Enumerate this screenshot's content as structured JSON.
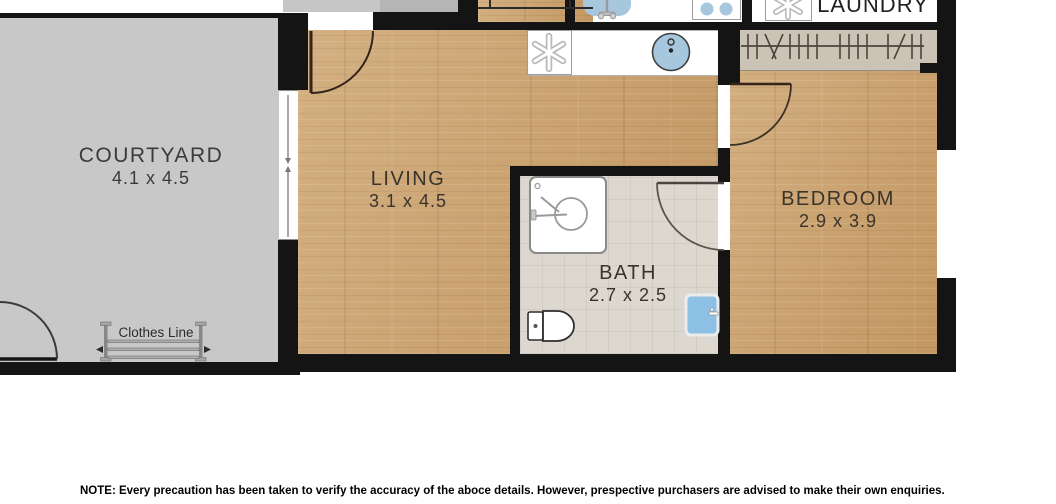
{
  "floorplan": {
    "rooms": [
      {
        "name": "COURTYARD",
        "dims": "4.1 x 4.5"
      },
      {
        "name": "LIVING",
        "dims": "3.1 x 4.5"
      },
      {
        "name": "BATH",
        "dims": "2.7 x 2.5"
      },
      {
        "name": "BEDROOM",
        "dims": "2.9 x 3.9"
      },
      {
        "name": "LAUNDRY"
      }
    ],
    "clothes_line_label": "Clothes Line",
    "icons": [
      "shower-icon",
      "toilet-icon",
      "vanity-basin-icon",
      "kitchen-sink-icon",
      "dishwasher-icon",
      "cooktop-icon",
      "laundry-tub-icon",
      "washing-machine-icon",
      "clothes-hangers-icon",
      "clothes-line-icon",
      "door-swing-icon",
      "sliding-door-icon",
      "stairs-icon",
      "window-icon"
    ],
    "colors": {
      "wall": "#141414",
      "courtyard": "#c8c8c8",
      "wood_floor": "#c79e6a",
      "bath_tile": "#ddd8cf",
      "robe": "#cbc3b5",
      "fixture_blue": "#a7c7de",
      "vanity_blue": "#8cc0e4"
    }
  },
  "note": "NOTE: Every precaution has been taken to verify the accuracy of the aboce details. However, prespective purchasers are advised to make their own enquiries."
}
